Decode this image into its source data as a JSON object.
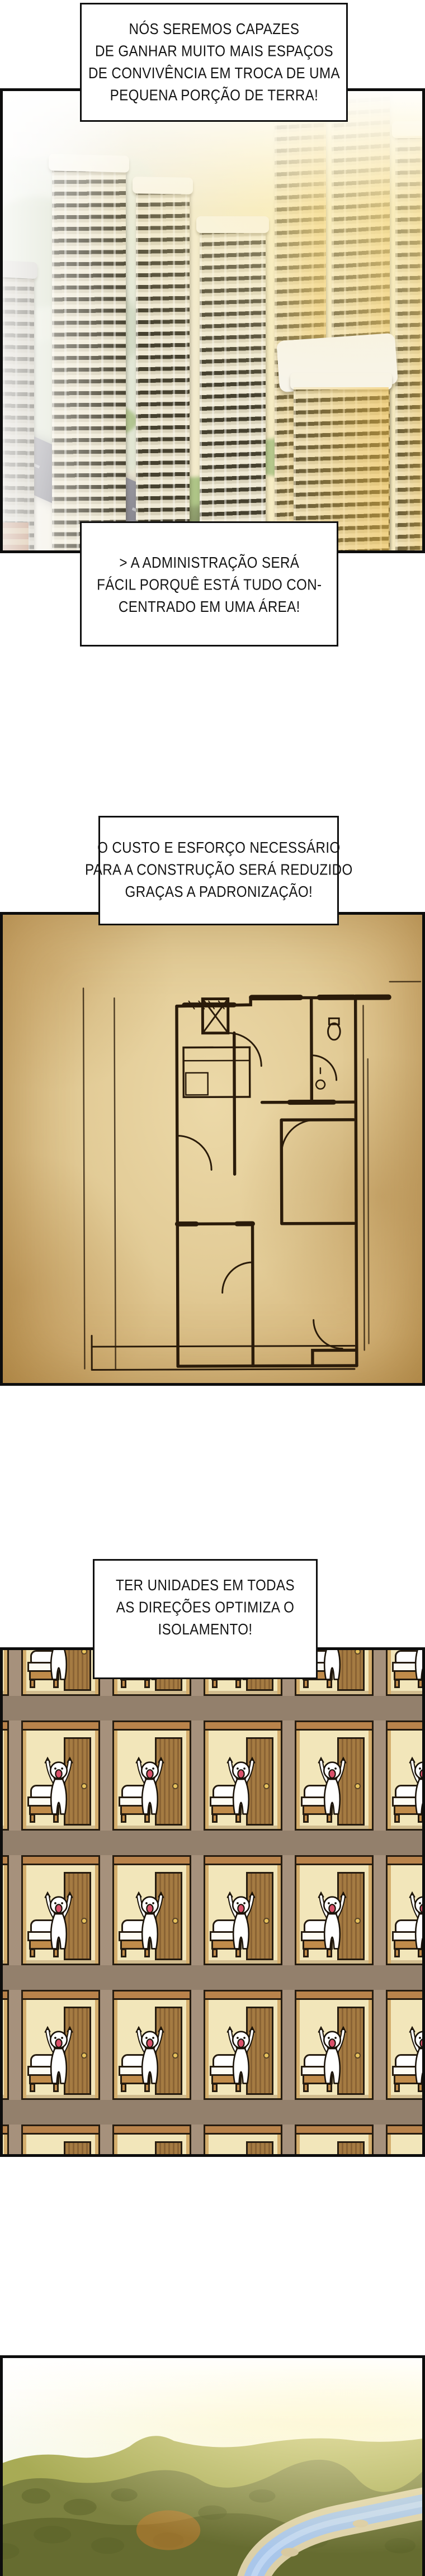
{
  "page_title": "página de manhwa",
  "colors": {
    "ink": "#111111",
    "panel-border": "#0d0d0d",
    "parchment": "#e2cb96",
    "plan-ink": "#2a1b0a",
    "wall": "#a6917c",
    "room-bg": "#f2e6ba",
    "wood": "#b9834b",
    "wood-dark": "#8a6334",
    "outline": "#261c10",
    "mouth": "#d9506a",
    "river": "#a9c6ea",
    "sand": "#dcd0a8",
    "forest": "#7c8140",
    "forest-dark": "#666c30",
    "forest-light": "#a8ab55",
    "sun-glow": "#fff7c8"
  },
  "bubbles": {
    "b1": {
      "lines": [
        "NÓS SEREMOS CAPAZES",
        "DE GANHAR MUITO MAIS ESPAÇOS",
        "DE CONVIVÊNCIA EM TROCA DE UMA",
        "PEQUENA PORÇÃO DE TERRA!"
      ]
    },
    "b2": {
      "lines": [
        "> A ADMINISTRAÇÃO SERÁ",
        "FÁCIL PORQUÊ ESTÁ TUDO CON-",
        "CENTRADO EM UMA ÁREA!"
      ]
    },
    "b3": {
      "lines": [
        "O CUSTO E ESFORÇO NECESSÁRIO",
        "PARA A CONSTRUÇÃO SERÁ REDUZIDO",
        "GRAÇAS A PADRONIZAÇÃO!"
      ]
    },
    "b4": {
      "lines": [
        "TER UNIDADES EM TODAS",
        "AS DIREÇÕES OPTIMIZA O",
        "ISOLAMENTO!"
      ]
    }
  },
  "panels": {
    "city": {
      "alt": "vista aérea de torres residenciais"
    },
    "floor_plan": {
      "alt": "planta baixa desenhada à mão em pergaminho"
    },
    "cross_section": {
      "alt": "grade de unidades idênticas com moradores comemorando",
      "columns": 6,
      "rows": 5
    },
    "landscape": {
      "alt": "floresta com rio sinuoso ao pôr do sol"
    }
  }
}
